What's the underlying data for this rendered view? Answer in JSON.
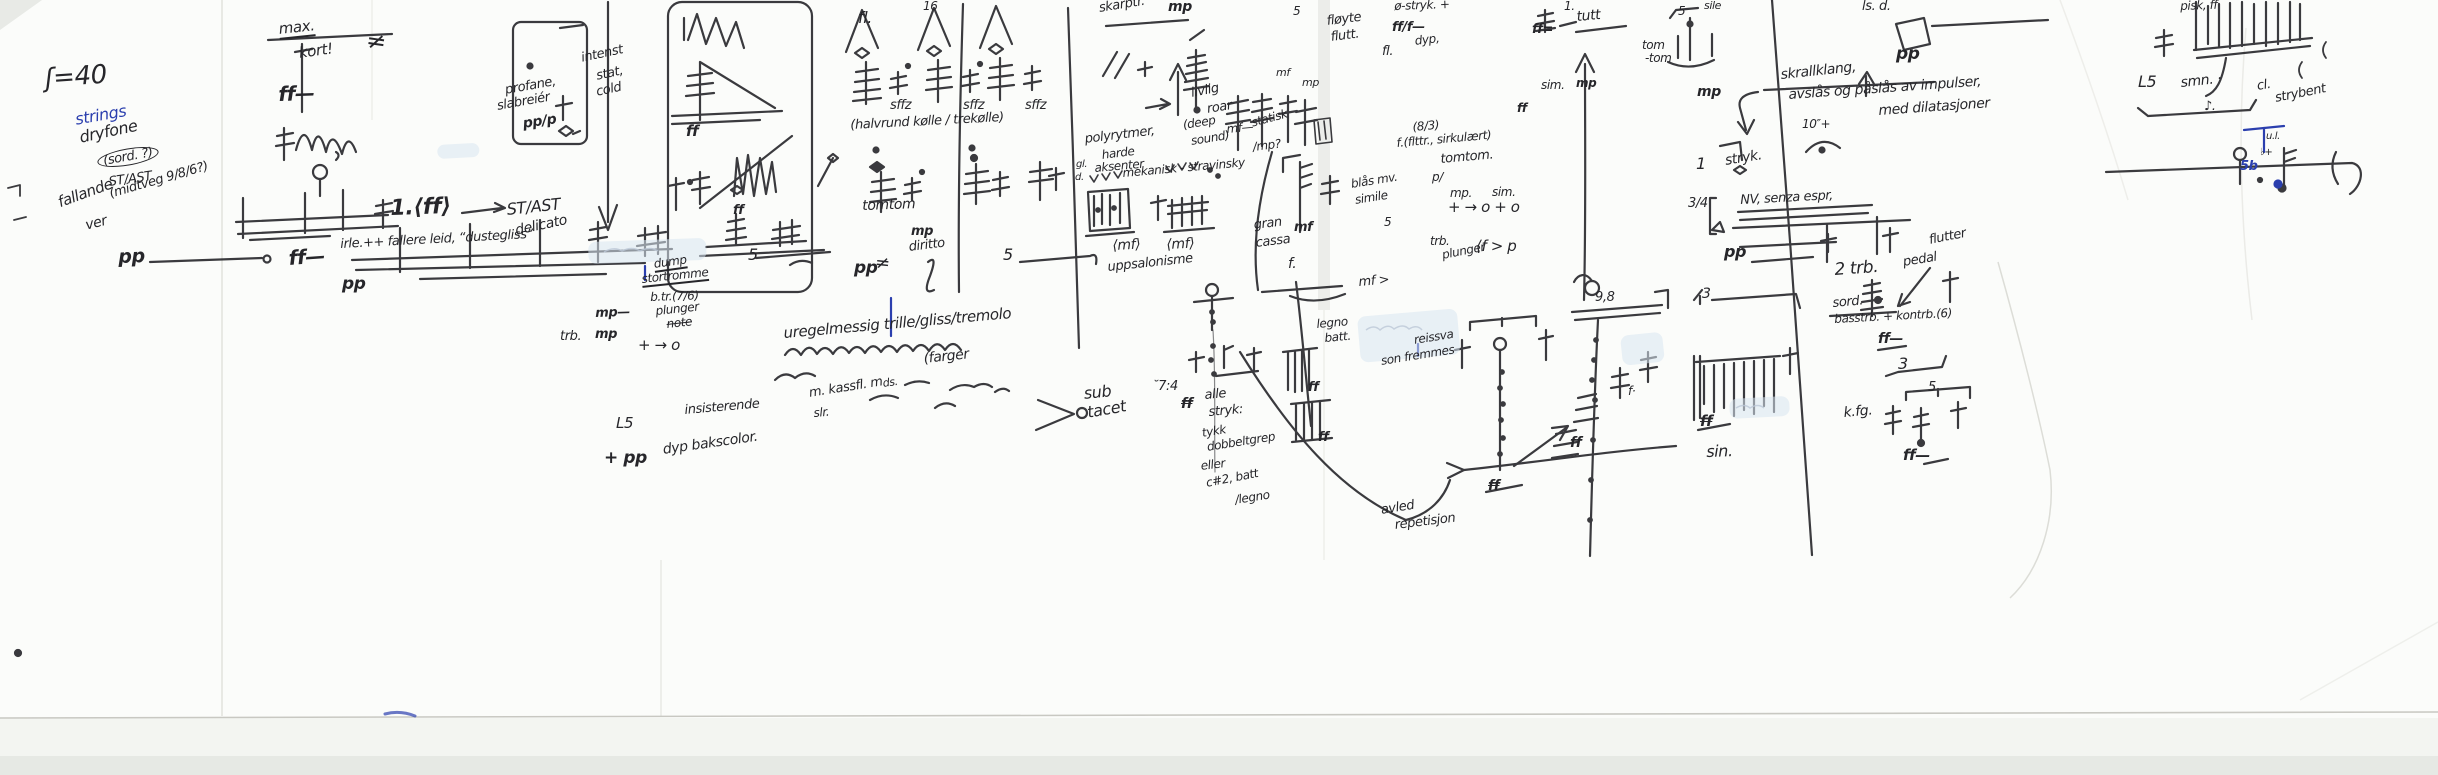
{
  "page": {
    "description": "Handwritten musical sketch page, black ink on creased white paper, scanned",
    "tempo_marking": "ʃ=40"
  },
  "palette": {
    "ink": "#26262a",
    "blue": "#2b3fae",
    "highlight": "#d9e6f0",
    "paper": "#fbfcfa"
  },
  "fields": [
    "name",
    "text",
    "x",
    "y",
    "size",
    "rotate_deg",
    "style_flags(b,u,s,c)",
    "color"
  ],
  "annotations": [
    [
      "tempo-marking",
      "ʃ=40",
      44,
      66,
      26,
      -4,
      "",
      ""
    ],
    [
      "strings-label",
      "strings",
      74,
      112,
      16,
      -10,
      "",
      "blue"
    ],
    [
      "annotation",
      "dryfone",
      78,
      130,
      16,
      -12,
      "",
      ""
    ],
    [
      "annotation",
      "(sord. ?)",
      96,
      154,
      13,
      -10,
      "c",
      ""
    ],
    [
      "annotation",
      "ST/AST",
      108,
      176,
      13,
      -8,
      "",
      ""
    ],
    [
      "annotation",
      "fallande",
      56,
      196,
      15,
      -20,
      "",
      ""
    ],
    [
      "annotation",
      "ver",
      84,
      219,
      14,
      -14,
      "",
      ""
    ],
    [
      "annotation",
      "(midtveg 9/8/6?)",
      108,
      188,
      13,
      -16,
      "",
      ""
    ],
    [
      "dynamic-pp",
      "pp",
      118,
      248,
      19,
      -2,
      "b",
      ""
    ],
    [
      "annotation",
      "max.",
      278,
      22,
      15,
      -6,
      "u",
      ""
    ],
    [
      "annotation",
      "kort!",
      298,
      46,
      15,
      -8,
      "",
      ""
    ],
    [
      "dynamic-ff",
      "ff—",
      278,
      84,
      20,
      -2,
      "b",
      ""
    ],
    [
      "sharp-sign",
      "≠",
      368,
      28,
      24,
      8,
      "",
      ""
    ],
    [
      "annotation",
      "1.⟨ff⟩",
      390,
      198,
      22,
      -2,
      "b",
      ""
    ],
    [
      "dynamic-ff",
      "ff—",
      288,
      248,
      20,
      -4,
      "b",
      ""
    ],
    [
      "dynamic-pp",
      "pp",
      342,
      276,
      17,
      0,
      "b",
      ""
    ],
    [
      "annotation",
      "irle.++ fallere leid, “dustegliss”",
      340,
      238,
      13,
      -3,
      "",
      ""
    ],
    [
      "annotation",
      "profane,",
      504,
      84,
      13,
      -10,
      "",
      ""
    ],
    [
      "annotation",
      "slabreiér",
      496,
      100,
      13,
      -10,
      "",
      ""
    ],
    [
      "annotation",
      "pp/p",
      522,
      117,
      14,
      -8,
      "b",
      ""
    ],
    [
      "annotation",
      "intenst",
      580,
      52,
      13,
      -12,
      "",
      ""
    ],
    [
      "annotation",
      "stat,",
      595,
      70,
      13,
      -12,
      "",
      ""
    ],
    [
      "annotation",
      "cold",
      595,
      86,
      13,
      -12,
      "",
      ""
    ],
    [
      "annotation",
      "ST/AST",
      506,
      202,
      16,
      -6,
      "",
      ""
    ],
    [
      "annotation",
      "delicato",
      514,
      224,
      14,
      -12,
      "",
      ""
    ],
    [
      "dynamic-ff",
      "ff",
      686,
      124,
      15,
      0,
      "b",
      ""
    ],
    [
      "dynamic-ff",
      "ff",
      733,
      204,
      13,
      0,
      "b",
      ""
    ],
    [
      "annotation",
      "5",
      748,
      247,
      16,
      0,
      "",
      ""
    ],
    [
      "annotation",
      "5",
      1003,
      247,
      16,
      0,
      "",
      ""
    ],
    [
      "dynamic-pp",
      "pp",
      854,
      260,
      17,
      0,
      "b",
      ""
    ],
    [
      "sharp-sign",
      "≠",
      876,
      254,
      18,
      6,
      "",
      ""
    ],
    [
      "annotation",
      "dump",
      653,
      258,
      12,
      -8,
      "u",
      ""
    ],
    [
      "annotation",
      "stortromme",
      641,
      273,
      12,
      -6,
      "u",
      ""
    ],
    [
      "annotation",
      "b.tr.(7/6)",
      650,
      291,
      12,
      -2,
      "",
      ""
    ],
    [
      "annotation",
      "mp—",
      595,
      307,
      13,
      -2,
      "b",
      ""
    ],
    [
      "annotation",
      "plunger",
      655,
      305,
      12,
      -6,
      "",
      ""
    ],
    [
      "annotation",
      "note",
      666,
      318,
      12,
      -6,
      "s",
      ""
    ],
    [
      "annotation",
      "trb.",
      560,
      330,
      13,
      0,
      "",
      ""
    ],
    [
      "annotation",
      "mp",
      595,
      328,
      13,
      0,
      "b",
      ""
    ],
    [
      "annotation",
      "+ → o",
      638,
      338,
      15,
      0,
      "",
      ""
    ],
    [
      "annotation",
      "L5",
      616,
      416,
      15,
      0,
      "",
      ""
    ],
    [
      "annotation",
      "insisterende",
      684,
      404,
      13,
      -5,
      "",
      ""
    ],
    [
      "annotation",
      "+ pp",
      604,
      450,
      17,
      0,
      "b",
      ""
    ],
    [
      "annotation",
      "dyp bakscolor.",
      662,
      443,
      14,
      -8,
      "",
      ""
    ],
    [
      "annotation",
      "uregelmessig trille/gliss/tremolo",
      783,
      326,
      15,
      -5,
      "",
      ""
    ],
    [
      "annotation",
      "(farger",
      923,
      352,
      14,
      -6,
      "",
      ""
    ],
    [
      "annotation",
      "ds.",
      882,
      378,
      11,
      -8,
      "",
      ""
    ],
    [
      "annotation",
      "m. kassfl. m",
      808,
      387,
      13,
      -9,
      "",
      ""
    ],
    [
      "annotation",
      "slr.",
      813,
      407,
      12,
      -5,
      "",
      ""
    ],
    [
      "annotation",
      "sub",
      1083,
      386,
      16,
      -6,
      "",
      ""
    ],
    [
      "annotation",
      "tacet",
      1086,
      405,
      16,
      -10,
      "",
      ""
    ],
    [
      "annotation",
      "˘7:4",
      1152,
      380,
      13,
      0,
      "",
      ""
    ],
    [
      "dynamic-ff",
      "ff",
      1181,
      397,
      14,
      0,
      "bs",
      ""
    ],
    [
      "annotation",
      "alle",
      1204,
      389,
      13,
      -5,
      "",
      ""
    ],
    [
      "annotation",
      "stryk:",
      1208,
      406,
      13,
      -5,
      "",
      ""
    ],
    [
      "annotation",
      "tykk",
      1201,
      427,
      12,
      -9,
      "",
      ""
    ],
    [
      "annotation",
      "dobbeltgrep",
      1206,
      441,
      12,
      -9,
      "",
      ""
    ],
    [
      "annotation",
      "eller",
      1200,
      460,
      12,
      -7,
      "",
      ""
    ],
    [
      "annotation",
      "c#2, batt",
      1205,
      477,
      12,
      -11,
      "",
      ""
    ],
    [
      "annotation",
      "/legno",
      1234,
      494,
      12,
      -9,
      "",
      ""
    ],
    [
      "annotation",
      "legno",
      1316,
      318,
      12,
      -5,
      "",
      ""
    ],
    [
      "annotation",
      "batt.",
      1324,
      332,
      12,
      -5,
      "",
      ""
    ],
    [
      "dynamic-ff",
      "ff",
      1308,
      381,
      13,
      0,
      "b",
      ""
    ],
    [
      "dynamic-ff",
      "ff",
      1318,
      431,
      13,
      0,
      "b",
      ""
    ],
    [
      "annotation",
      "reissva",
      1413,
      334,
      12,
      -9,
      "",
      ""
    ],
    [
      "annotation",
      "son fremmes",
      1380,
      355,
      12,
      -9,
      "",
      ""
    ],
    [
      "annotation",
      "avled",
      1380,
      504,
      13,
      -9,
      "",
      ""
    ],
    [
      "annotation",
      "repetisjon",
      1394,
      519,
      13,
      -7,
      "",
      ""
    ],
    [
      "dynamic-ff",
      "ff",
      1488,
      479,
      14,
      0,
      "bs",
      ""
    ],
    [
      "dynamic-ff",
      "ff",
      1570,
      436,
      14,
      0,
      "b",
      ""
    ],
    [
      "annotation",
      "blås mv.",
      1350,
      178,
      12,
      -9,
      "",
      ""
    ],
    [
      "annotation",
      "simile",
      1354,
      194,
      12,
      -9,
      "",
      ""
    ],
    [
      "annotation",
      "5",
      1384,
      216,
      12,
      0,
      "",
      ""
    ],
    [
      "annotation",
      "mf >",
      1358,
      276,
      13,
      -5,
      "",
      ""
    ],
    [
      "annotation",
      "sffz",
      890,
      99,
      13,
      0,
      "",
      ""
    ],
    [
      "annotation",
      "sffz",
      963,
      99,
      13,
      0,
      "",
      ""
    ],
    [
      "annotation",
      "sffz",
      1025,
      99,
      13,
      0,
      "",
      ""
    ],
    [
      "annotation",
      "fl.",
      858,
      10,
      16,
      0,
      "",
      ""
    ],
    [
      "annotation",
      "16",
      923,
      0,
      12,
      0,
      "",
      ""
    ],
    [
      "annotation",
      "(halvrund kølle / trekølle)",
      850,
      119,
      13,
      -3,
      "",
      ""
    ],
    [
      "annotation",
      "tomtom",
      862,
      199,
      14,
      -2,
      "",
      ""
    ],
    [
      "annotation",
      "mp",
      911,
      225,
      13,
      0,
      "b",
      ""
    ],
    [
      "annotation",
      "diritto",
      908,
      241,
      13,
      -7,
      "",
      ""
    ],
    [
      "annotation",
      "skarptr.",
      1098,
      2,
      13,
      -9,
      "",
      ""
    ],
    [
      "annotation",
      "mp",
      1168,
      0,
      14,
      0,
      "b",
      ""
    ],
    [
      "annotation",
      "livlig",
      1190,
      87,
      13,
      -11,
      "",
      ""
    ],
    [
      "annotation",
      "roar",
      1206,
      103,
      13,
      -9,
      "",
      ""
    ],
    [
      "annotation",
      "(deep",
      1182,
      119,
      12,
      -9,
      "",
      ""
    ],
    [
      "annotation",
      "sound)",
      1190,
      135,
      12,
      -9,
      "",
      ""
    ],
    [
      "annotation",
      "mf—",
      1226,
      123,
      12,
      -5,
      "",
      ""
    ],
    [
      "annotation",
      "statisk",
      1250,
      117,
      12,
      -15,
      "",
      ""
    ],
    [
      "annotation",
      "/mp?",
      1252,
      141,
      12,
      -7,
      "",
      ""
    ],
    [
      "annotation",
      "polyrytmer,",
      1084,
      133,
      13,
      -7,
      "",
      ""
    ],
    [
      "annotation",
      "harde",
      1101,
      149,
      12,
      -7,
      "",
      ""
    ],
    [
      "annotation",
      "aksenter",
      1094,
      162,
      12,
      -5,
      "",
      ""
    ],
    [
      "annotation",
      "mekanisk - stravinsky",
      1122,
      167,
      12,
      -5,
      "",
      ""
    ],
    [
      "annotation",
      "gl.",
      1076,
      160,
      10,
      0,
      "",
      ""
    ],
    [
      "annotation",
      "d.",
      1075,
      173,
      10,
      0,
      "",
      ""
    ],
    [
      "annotation",
      "gran",
      1253,
      219,
      13,
      -7,
      "",
      ""
    ],
    [
      "annotation",
      "mf",
      1294,
      221,
      13,
      0,
      "b",
      ""
    ],
    [
      "annotation",
      "cassa",
      1255,
      237,
      13,
      -7,
      "",
      ""
    ],
    [
      "annotation",
      "f.",
      1288,
      257,
      14,
      0,
      "",
      ""
    ],
    [
      "annotation",
      "⟨mf⟩",
      1112,
      239,
      14,
      -3,
      "",
      ""
    ],
    [
      "annotation",
      "⟨mf⟩",
      1166,
      238,
      14,
      -3,
      "",
      ""
    ],
    [
      "annotation",
      "uppsalonisme",
      1107,
      261,
      13,
      -6,
      "",
      ""
    ],
    [
      "annotation",
      "ø-stryk. +",
      1394,
      0,
      12,
      -2,
      "",
      ""
    ],
    [
      "annotation",
      "ff/f—",
      1392,
      21,
      13,
      0,
      "b",
      ""
    ],
    [
      "annotation",
      "dyp,",
      1414,
      35,
      12,
      -7,
      "",
      ""
    ],
    [
      "annotation",
      "fl.",
      1382,
      45,
      13,
      0,
      "",
      ""
    ],
    [
      "annotation",
      "fløyte",
      1326,
      15,
      13,
      -7,
      "",
      ""
    ],
    [
      "annotation",
      "flutt.",
      1330,
      31,
      13,
      -7,
      "",
      ""
    ],
    [
      "annotation",
      "mf",
      1276,
      67,
      11,
      0,
      "",
      ""
    ],
    [
      "annotation",
      "mp",
      1302,
      77,
      11,
      0,
      "",
      ""
    ],
    [
      "annotation",
      "5",
      1293,
      5,
      12,
      0,
      "",
      ""
    ],
    [
      "annotation",
      "(8/3)",
      1412,
      121,
      12,
      -5,
      "",
      ""
    ],
    [
      "annotation",
      "f.(flttr., sirkulært)",
      1396,
      137,
      12,
      -5,
      "",
      ""
    ],
    [
      "annotation",
      "tomtom.",
      1440,
      153,
      13,
      -5,
      "",
      ""
    ],
    [
      "annotation",
      "p/",
      1432,
      171,
      12,
      0,
      "",
      ""
    ],
    [
      "annotation",
      "mp.",
      1450,
      187,
      12,
      0,
      "",
      ""
    ],
    [
      "annotation",
      "sim.",
      1492,
      186,
      12,
      0,
      "",
      ""
    ],
    [
      "annotation",
      "+ → o + o",
      1448,
      200,
      15,
      0,
      "",
      ""
    ],
    [
      "annotation",
      "trb.",
      1430,
      235,
      12,
      0,
      "",
      ""
    ],
    [
      "annotation",
      "plunger",
      1441,
      249,
      12,
      -11,
      "",
      ""
    ],
    [
      "annotation",
      "⟨f > p",
      1476,
      239,
      15,
      0,
      "",
      ""
    ],
    [
      "dynamic-ff",
      "ff",
      1517,
      102,
      12,
      0,
      "b",
      ""
    ],
    [
      "annotation",
      "sim.",
      1541,
      79,
      12,
      0,
      "",
      ""
    ],
    [
      "annotation",
      "1.",
      1564,
      0,
      12,
      0,
      "",
      ""
    ],
    [
      "annotation",
      "tutt",
      1576,
      10,
      14,
      -5,
      "",
      ""
    ],
    [
      "annotation",
      "ff=",
      1532,
      23,
      13,
      0,
      "b",
      ""
    ],
    [
      "annotation",
      "tom",
      1642,
      39,
      12,
      0,
      "",
      ""
    ],
    [
      "annotation",
      "-tom",
      1645,
      52,
      12,
      0,
      "",
      ""
    ],
    [
      "annotation",
      "sile",
      1704,
      0,
      11,
      0,
      "",
      ""
    ],
    [
      "annotation",
      "5",
      1678,
      5,
      12,
      0,
      "",
      ""
    ],
    [
      "annotation",
      "mp",
      1697,
      85,
      14,
      0,
      "b",
      ""
    ],
    [
      "annotation",
      "mp",
      1576,
      77,
      12,
      0,
      "b",
      ""
    ],
    [
      "annotation",
      "skrallklang,",
      1780,
      68,
      14,
      -6,
      "",
      ""
    ],
    [
      "annotation",
      "avslås og påslås av impulser,",
      1788,
      88,
      14,
      -4,
      "",
      ""
    ],
    [
      "annotation",
      "med dilatasjoner",
      1878,
      104,
      14,
      -4,
      "",
      ""
    ],
    [
      "dynamic-pp",
      "pp",
      1896,
      46,
      17,
      0,
      "b",
      ""
    ],
    [
      "annotation",
      "ls. d.",
      1862,
      0,
      13,
      0,
      "",
      ""
    ],
    [
      "annotation",
      "10″+",
      1802,
      118,
      12,
      0,
      "",
      ""
    ],
    [
      "annotation",
      "1",
      1696,
      156,
      16,
      0,
      "",
      ""
    ],
    [
      "annotation",
      "stryk.",
      1724,
      154,
      14,
      -9,
      "",
      ""
    ],
    [
      "annotation",
      "3/4",
      1688,
      197,
      13,
      0,
      "",
      ""
    ],
    [
      "annotation",
      "NV, senza espr,",
      1740,
      194,
      13,
      -3,
      "",
      ""
    ],
    [
      "dynamic-pp",
      "pp",
      1724,
      244,
      16,
      0,
      "b",
      ""
    ],
    [
      "annotation",
      "flutter",
      1928,
      234,
      13,
      -11,
      "",
      ""
    ],
    [
      "annotation",
      "2 trb.",
      1834,
      262,
      17,
      -4,
      "",
      ""
    ],
    [
      "annotation",
      "pedal",
      1902,
      256,
      13,
      -9,
      "",
      ""
    ],
    [
      "annotation",
      "sord.",
      1832,
      297,
      13,
      -5,
      "",
      ""
    ],
    [
      "annotation",
      "basstrb. + kontrb.(6)",
      1834,
      313,
      12,
      -3,
      "",
      ""
    ],
    [
      "dynamic-ff",
      "ff—",
      1878,
      332,
      14,
      0,
      "b",
      ""
    ],
    [
      "annotation",
      "3",
      1898,
      356,
      16,
      0,
      "",
      ""
    ],
    [
      "annotation",
      "5",
      1928,
      381,
      13,
      0,
      "",
      ""
    ],
    [
      "annotation",
      "k.fg.",
      1843,
      406,
      14,
      -5,
      "",
      ""
    ],
    [
      "dynamic-ff",
      "ff—",
      1903,
      448,
      15,
      0,
      "b",
      ""
    ],
    [
      "annotation",
      "3",
      1702,
      287,
      14,
      0,
      "",
      ""
    ],
    [
      "dynamic-ff",
      "ff",
      1700,
      414,
      15,
      0,
      "bs",
      ""
    ],
    [
      "annotation",
      "sin.",
      1706,
      444,
      16,
      -2,
      "",
      ""
    ],
    [
      "annotation",
      "9,8",
      1595,
      291,
      13,
      0,
      "",
      ""
    ],
    [
      "annotation",
      "f·",
      1628,
      385,
      12,
      0,
      "",
      ""
    ],
    [
      "annotation",
      "pisk, ff",
      2180,
      0,
      12,
      -2,
      "",
      ""
    ],
    [
      "annotation",
      "L5",
      2138,
      74,
      16,
      0,
      "",
      ""
    ],
    [
      "annotation",
      "smn. ·",
      2180,
      76,
      14,
      -6,
      "",
      ""
    ],
    [
      "annotation",
      "♪.",
      2204,
      100,
      13,
      0,
      "",
      ""
    ],
    [
      "annotation",
      "cl.",
      2256,
      80,
      13,
      -9,
      "",
      ""
    ],
    [
      "annotation",
      "strybent",
      2274,
      92,
      13,
      -11,
      "",
      ""
    ],
    [
      "annotation",
      "u.l.",
      2266,
      132,
      10,
      0,
      "",
      ""
    ],
    [
      "annotation",
      "♭+",
      2260,
      148,
      10,
      0,
      "",
      ""
    ],
    [
      "annotation",
      "5b",
      2240,
      160,
      13,
      0,
      "b",
      "blue"
    ]
  ],
  "highlights": [
    {
      "x": 588,
      "y": 242,
      "w": 118,
      "h": 22,
      "rot": -2
    },
    {
      "x": 437,
      "y": 145,
      "w": 42,
      "h": 14,
      "rot": -3
    },
    {
      "x": 1357,
      "y": 317,
      "w": 100,
      "h": 46,
      "rot": -5
    },
    {
      "x": 1729,
      "y": 399,
      "w": 60,
      "h": 20,
      "rot": -3
    },
    {
      "x": 1620,
      "y": 336,
      "w": 42,
      "h": 30,
      "rot": -6
    }
  ]
}
